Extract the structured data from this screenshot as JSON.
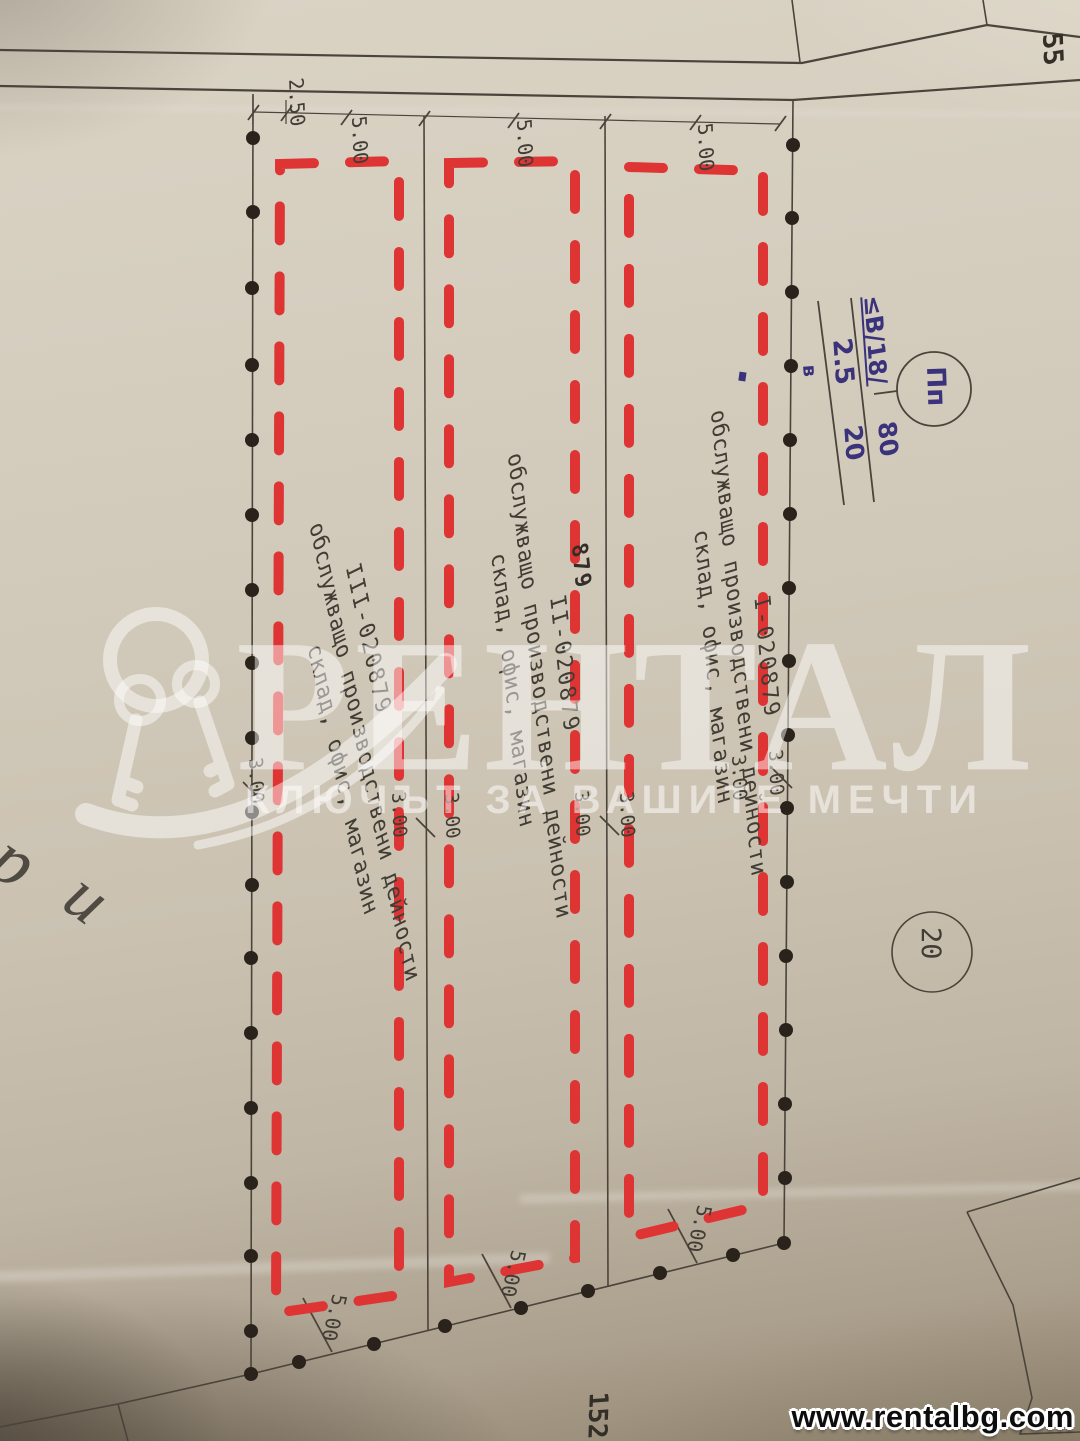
{
  "watermark": {
    "brand": "РЕНТАЛ",
    "tagline": "КЛЮЧЪТ ЗА ВАШИТЕ МЕЧТИ",
    "website": "www.rentalbg.com",
    "logo_icon": "keys-crescent-logo",
    "colors": {
      "overlay_white": "#ffffff"
    }
  },
  "parcels": {
    "p1": {
      "id": "I-020879",
      "use": "обслужващо производствени дейности",
      "use2": "склад, офис, магазин"
    },
    "p2": {
      "number": "879",
      "id": "II-020879",
      "use": "обслужващо производствени дейности",
      "use2": "склад, офис, магазин"
    },
    "p3": {
      "id": "III-020879",
      "use": "обслужващо производствени дейности",
      "use2": "склад, офис, магазин"
    }
  },
  "neighbors": {
    "parcel_55": "55",
    "parcel_152": "152",
    "point_20": "20"
  },
  "zoning": {
    "zone": "Пп",
    "height_limit": "≤В/18/",
    "kint": "2.5",
    "density": "80",
    "greenery": "20",
    "letter": "в"
  },
  "dimensions": {
    "offset": "2.50",
    "width_5": "5.00",
    "gap_3": "3.00"
  },
  "street_fragment": {
    "char_partial": "а",
    "char1": "р",
    "char2": "и"
  },
  "colors": {
    "c-red": "#de3434",
    "c-line": "#4a443b",
    "c-ink": "#3a327a",
    "c-text": "#413c34"
  }
}
